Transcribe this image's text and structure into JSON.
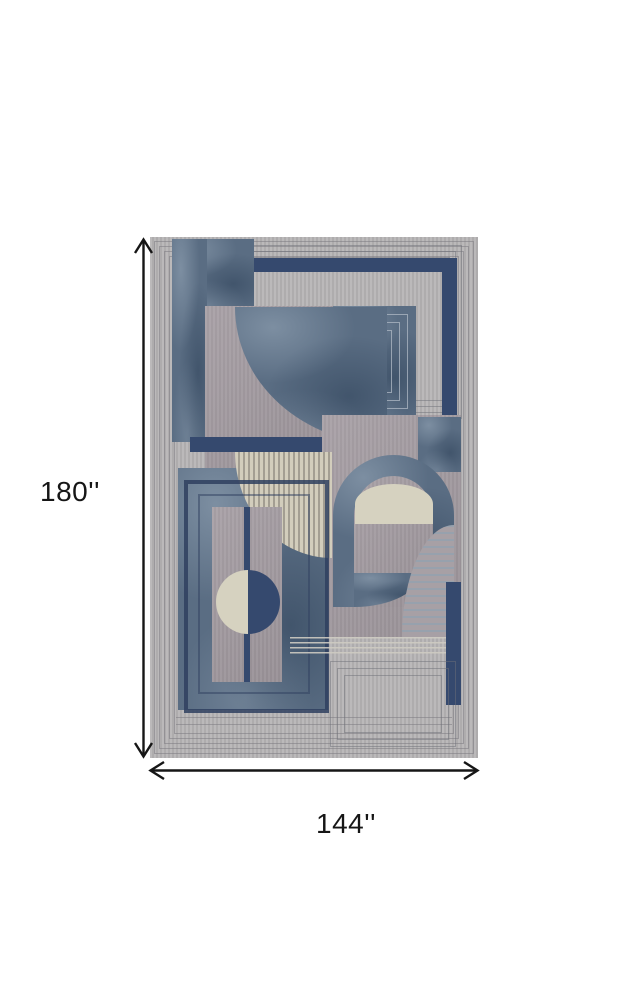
{
  "dimensions": {
    "height_label": "180''",
    "width_label": "144''"
  },
  "palette": {
    "canvas_bg": "#ffffff",
    "rug_base_gray": "#b7b5b6",
    "border_line_gray": "#8d8c91",
    "velvet_blue": "#5a6d83",
    "velvet_blue_light": "#8a9aab",
    "velvet_blue_dark": "#41556b",
    "navy": "#35496e",
    "mauve_gray": "#a39ba1",
    "cream": "#d6d2c0",
    "dimension_black": "#161616"
  }
}
